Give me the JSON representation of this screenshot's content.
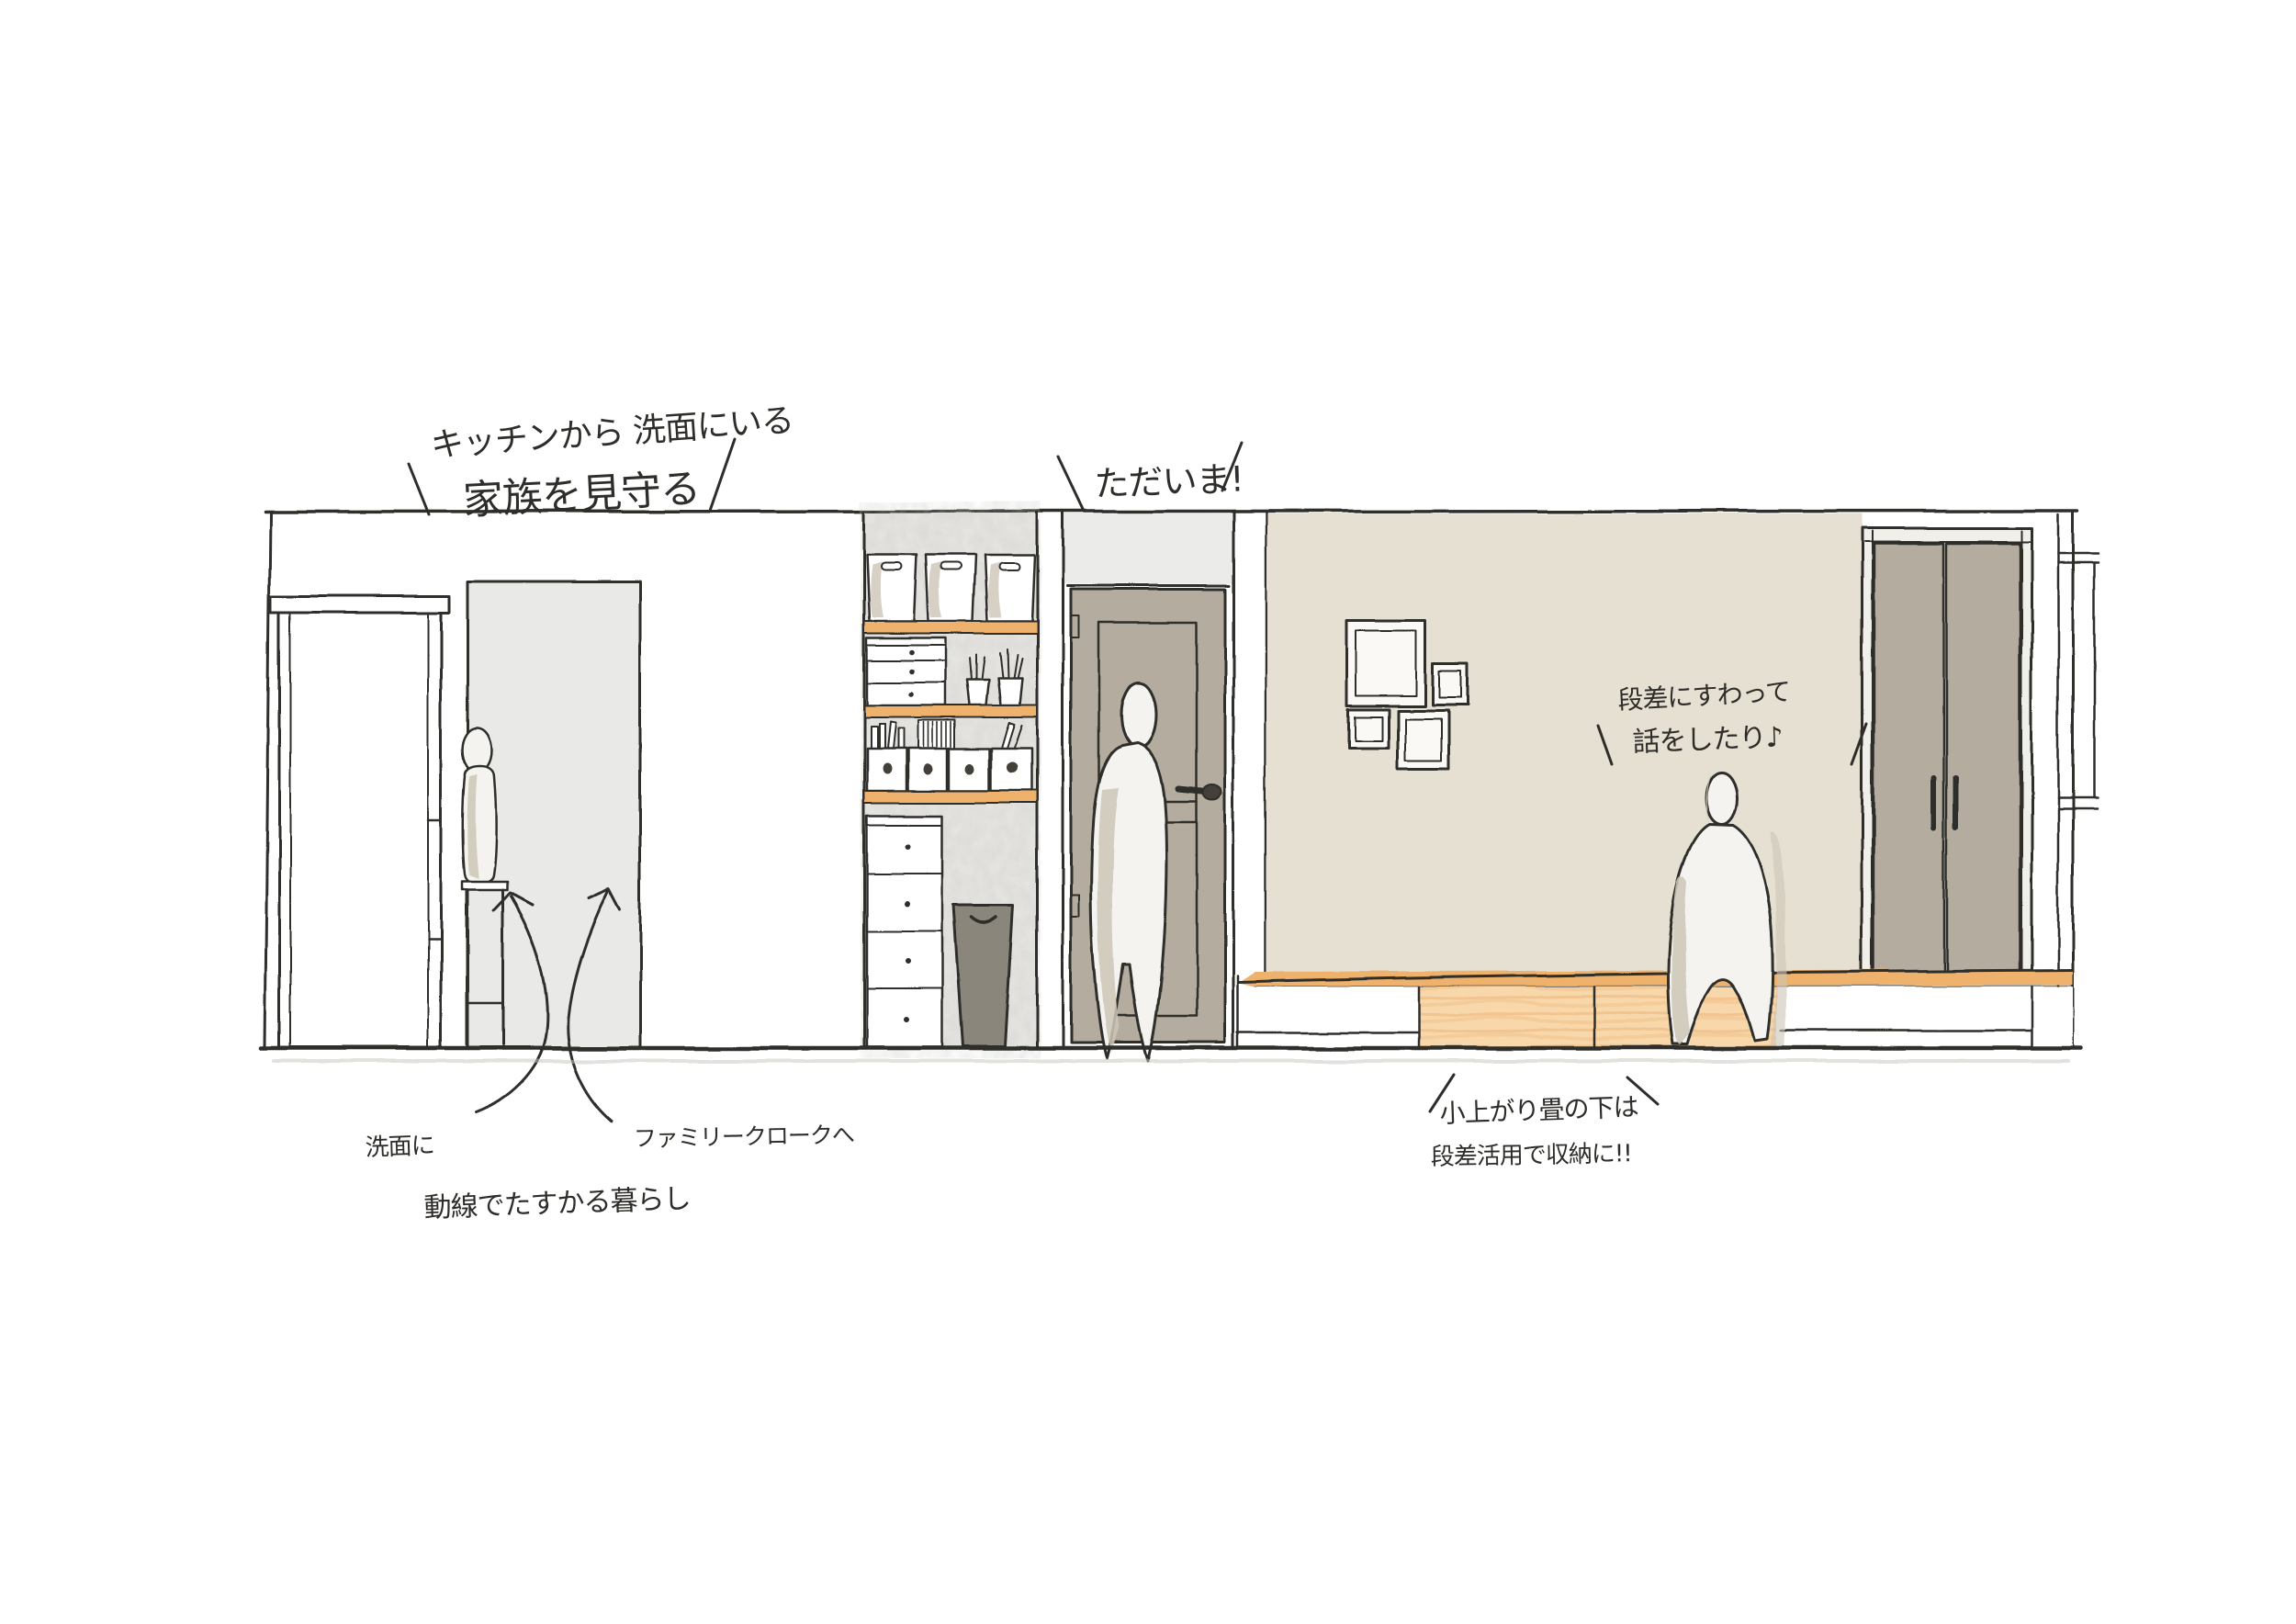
{
  "annotations": {
    "kitchen_watch": {
      "line1": "キッチンから 洗面にいる",
      "line2": "家族を見守る"
    },
    "greeting": "ただいま!",
    "step_sit": {
      "line1": "段差にすわって",
      "line2": "話をしたり♪"
    },
    "washroom": "洗面に",
    "family_cloak": "ファミリークロークへ",
    "flow": "動線でたすかる暮らし",
    "tatami": {
      "line1": "小上がり畳の下は",
      "line2": "段差活用で収納に!!"
    }
  },
  "colors": {
    "ink": "#2e2d2a",
    "doorway-gray": "#e9e9e8",
    "transom-gray": "#ebebea",
    "door-taupe": "#b4ad9f",
    "beige-wall": "#e6e0d2",
    "wood-orange": "#efb26c",
    "wood-light": "#f8d7ab",
    "wood-streak": "#ecb77e",
    "bin-gray": "#8b867c",
    "shadow-taupe": "#cdc5b6",
    "concrete-base": "#e7e6e3",
    "figure-white": "#f4f3f0",
    "frame-white": "#faf9f6",
    "closet-frame": "#f1efe9",
    "floor-shadow": "#c7c4be"
  }
}
